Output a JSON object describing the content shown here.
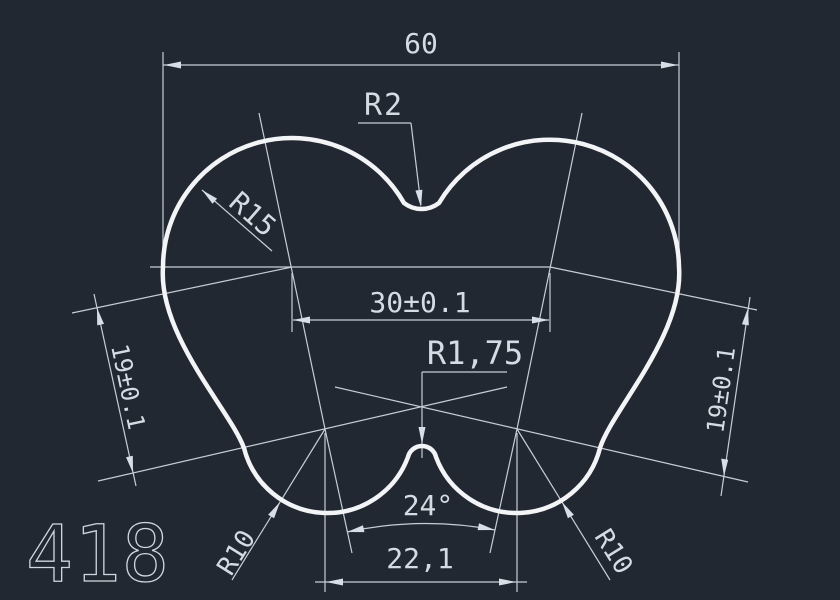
{
  "drawing": {
    "type": "cad-technical-drawing",
    "part_number": "418",
    "colors": {
      "background": "#212832",
      "outline": "#f2f4f6",
      "dimensions": "#c6cdd7",
      "text": "#d5dbe3"
    },
    "labels": {
      "overall_width": "60",
      "top_notch_radius": "R2",
      "lobe_radius": "R15",
      "lobe_center_distance": "30±0.1",
      "bottom_bump_radius": "R1,75",
      "side_height_left": "19±0.1",
      "side_height_right": "19±0.1",
      "bottom_angle": "24°",
      "bottom_center_distance": "22,1",
      "bottom_radius_left": "R10",
      "bottom_radius_right": "R10"
    }
  }
}
